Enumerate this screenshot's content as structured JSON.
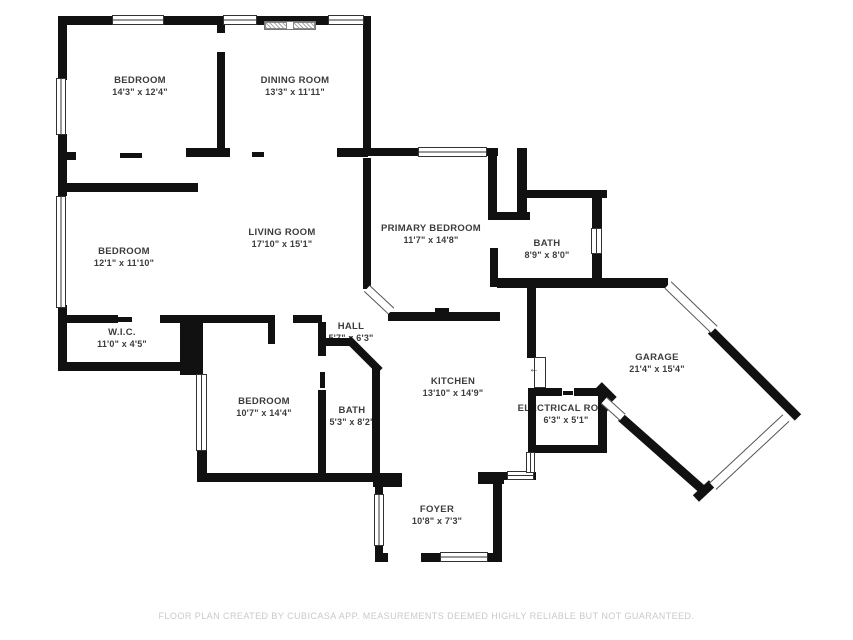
{
  "floor_plan": {
    "colors": {
      "background": "#ffffff",
      "walls": "#111111",
      "label_text": "#3c3c3c",
      "disclaimer_text": "#c9c9c9"
    },
    "rooms": [
      {
        "name": "BEDROOM",
        "dims": "14'3\" x 12'4\""
      },
      {
        "name": "DINING ROOM",
        "dims": "13'3\" x 11'11\""
      },
      {
        "name": "BEDROOM",
        "dims": "12'1\" x 11'10\""
      },
      {
        "name": "LIVING ROOM",
        "dims": "17'10\" x 15'1\""
      },
      {
        "name": "PRIMARY BEDROOM",
        "dims": "11'7\" x 14'8\""
      },
      {
        "name": "BATH",
        "dims": "8'9\" x 8'0\""
      },
      {
        "name": "W.I.C.",
        "dims": "11'0\" x 4'5\""
      },
      {
        "name": "HALL",
        "dims": "5'7\" x 6'3\""
      },
      {
        "name": "BEDROOM",
        "dims": "10'7\" x 14'4\""
      },
      {
        "name": "BATH",
        "dims": "5'3\" x 8'2\""
      },
      {
        "name": "KITCHEN",
        "dims": "13'10\" x 14'9\""
      },
      {
        "name": "ELECTRICAL ROOM",
        "dims": "6'3\" x 5'1\""
      },
      {
        "name": "GARAGE",
        "dims": "21'4\" x 15'4\""
      },
      {
        "name": "FOYER",
        "dims": "10'8\" x 7'3\""
      }
    ],
    "icons": {
      "door_swing_arrow": "←"
    },
    "disclaimer": "FLOOR PLAN CREATED BY CUBICASA APP. MEASUREMENTS DEEMED HIGHLY RELIABLE BUT NOT GUARANTEED."
  }
}
